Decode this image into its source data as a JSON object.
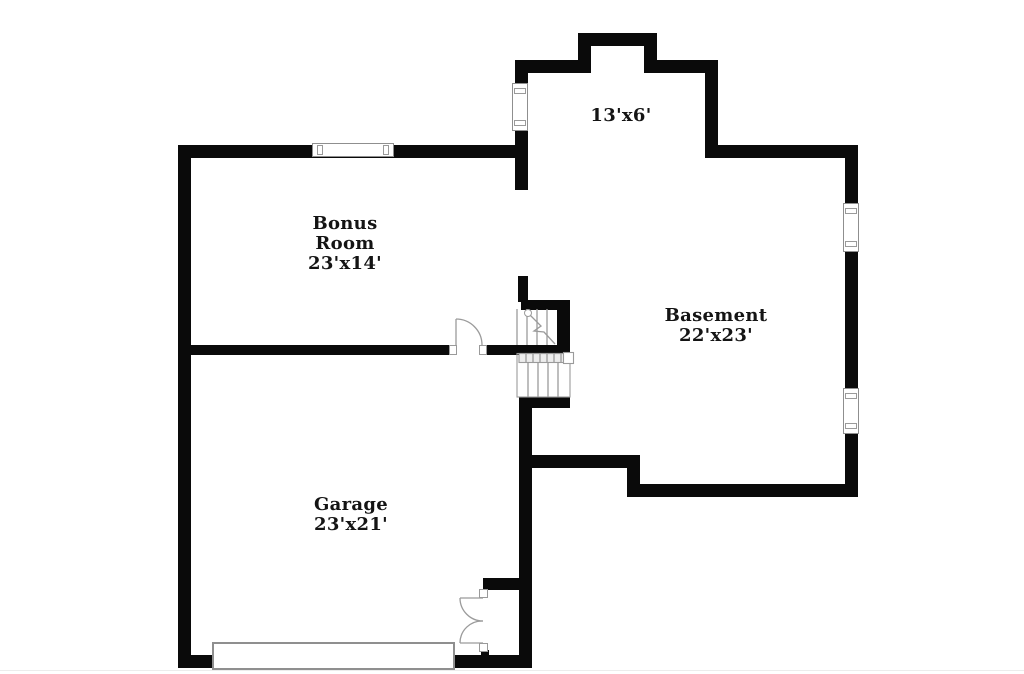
{
  "rooms": {
    "bonus": {
      "line1": "Bonus",
      "line2": "Room",
      "dims": "23'x14'"
    },
    "basement": {
      "name": "Basement",
      "dims": "22'x23'"
    },
    "garage": {
      "name": "Garage",
      "dims": "23'x21'"
    },
    "nook": {
      "dims": "13'x6'"
    }
  },
  "symbols": {
    "windows": [
      "bonus-room-top-window",
      "nook-left-window",
      "basement-right-upper-window",
      "basement-right-lower-window"
    ],
    "doors": [
      "bonus-room-swing-door",
      "garage-double-swing-door",
      "garage-overhead-door"
    ],
    "stairs": "central-staircase"
  },
  "colors": {
    "wall": "#0a0a0a",
    "detail_line": "#9b9b9b",
    "text": "#141414",
    "background": "#ffffff"
  }
}
